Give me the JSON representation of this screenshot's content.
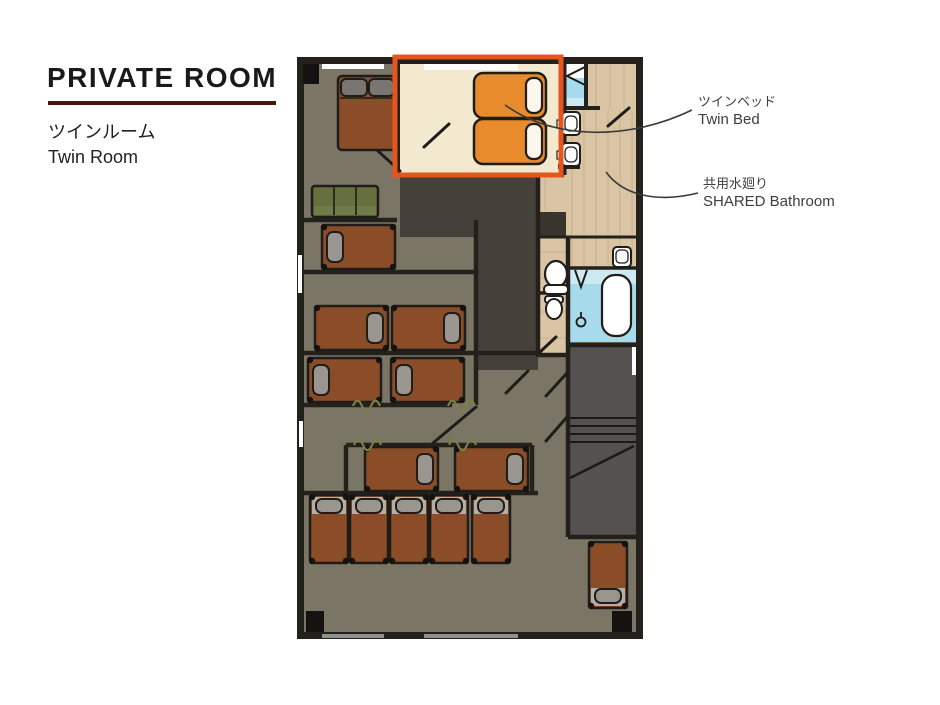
{
  "header": {
    "title": "PRIVATE ROOM",
    "room_name_jp": "ツインルーム",
    "room_name_en": "Twin Room"
  },
  "callouts": {
    "twin_bed": {
      "label_jp": "ツインベッド",
      "label_en": "Twin Bed"
    },
    "shared_bathroom": {
      "label_jp": "共用水廻り",
      "label_en": "SHARED Bathroom"
    }
  },
  "colors": {
    "title_underline": "#4a1410",
    "highlight_box": "#e7551f",
    "twin_room_floor": "#f3e9cf",
    "twin_bed_orange": "#e78b2c",
    "twin_bed_pillow": "#fbf7ec",
    "dorm_floor": "#7b7566",
    "corridor_dark": "#46403a",
    "closet_dark": "#39342e",
    "wood_floor": "#d9c5a4",
    "water_blue": "#a7dbeb",
    "single_bed_brown": "#8a4d27",
    "pillow_gray": "#9a968f",
    "sofa_green": "#66703e",
    "stairs_gray": "#555150",
    "wall": "#24211c"
  }
}
